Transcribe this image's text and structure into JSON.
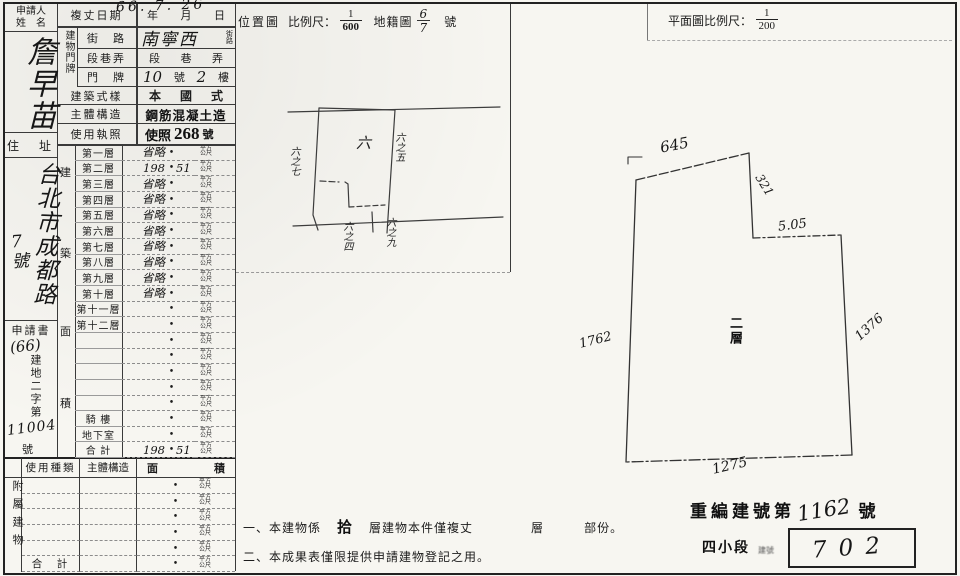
{
  "applicant": {
    "header_line1": "申請人",
    "header_line2": "姓　名",
    "name": "詹早苗",
    "address_label": "住　址",
    "address_main": "台北市成都路",
    "address_no": "7號",
    "form_label": "申請書",
    "form_year": "(66)",
    "form_word": "建地二字第",
    "form_no": "11004",
    "form_suffix": "號"
  },
  "survey": {
    "date_label": "複丈日期",
    "date_value": "66. 7. 26",
    "unit_y": "年",
    "unit_m": "月",
    "unit_d": "日"
  },
  "doorplate": {
    "group": "建物門牌",
    "street_label": "街　路",
    "street_value": "南寧西",
    "street_tiny_1": "街",
    "street_tiny_2": "路",
    "section_label": "段巷弄",
    "section_v1": "段",
    "section_v2": "巷",
    "section_v3": "弄",
    "door_label": "門　牌",
    "door_no": "10",
    "door_no_unit": "號",
    "door_floor": "2",
    "door_floor_unit": "樓"
  },
  "building": {
    "style_label": "建築式樣",
    "style_v1": "本",
    "style_v2": "國",
    "style_v3": "式",
    "structure_label": "主體構造",
    "structure_value": "鋼筋混凝土造",
    "license_label": "使用執照",
    "license_prefix": "使照",
    "license_no": "268",
    "license_suffix": "號"
  },
  "area_table": {
    "side_chars": {
      "c1": "建",
      "c2": "築",
      "c3": "面",
      "c4": "積"
    },
    "rows": [
      {
        "label": "第一層",
        "left": "省略",
        "right": ""
      },
      {
        "label": "第二層",
        "left": "198",
        "right": "51"
      },
      {
        "label": "第三層",
        "left": "省略",
        "right": ""
      },
      {
        "label": "第四層",
        "left": "省略",
        "right": ""
      },
      {
        "label": "第五層",
        "left": "省略",
        "right": ""
      },
      {
        "label": "第六層",
        "left": "省略",
        "right": ""
      },
      {
        "label": "第七層",
        "left": "省略",
        "right": ""
      },
      {
        "label": "第八層",
        "left": "省略",
        "right": ""
      },
      {
        "label": "第九層",
        "left": "省略",
        "right": ""
      },
      {
        "label": "第十層",
        "left": "省略",
        "right": ""
      },
      {
        "label": "第十一層",
        "left": "",
        "right": ""
      },
      {
        "label": "第十二層",
        "left": "",
        "right": ""
      },
      {
        "label": "",
        "left": "",
        "right": ""
      },
      {
        "label": "",
        "left": "",
        "right": ""
      },
      {
        "label": "",
        "left": "",
        "right": ""
      },
      {
        "label": "",
        "left": "",
        "right": ""
      },
      {
        "label": "",
        "left": "",
        "right": ""
      },
      {
        "label": "騎 樓",
        "left": "",
        "right": ""
      },
      {
        "label": "地下室",
        "left": "",
        "right": ""
      },
      {
        "label": "合 計",
        "left": "198",
        "right": "51"
      }
    ]
  },
  "units": {
    "dot": "•",
    "sqm1": "平方",
    "sqm2": "公尺"
  },
  "annex_table": {
    "side_label": "附屬建物",
    "h_use": "使用種類",
    "h_struct": "主體構造",
    "h_area_1": "面",
    "h_area_2": "積",
    "rows": [
      {
        "c1": "",
        "c2": "",
        "left": "",
        "right": ""
      },
      {
        "c1": "",
        "c2": "",
        "left": "",
        "right": ""
      },
      {
        "c1": "",
        "c2": "",
        "left": "",
        "right": ""
      },
      {
        "c1": "",
        "c2": "",
        "left": "",
        "right": ""
      },
      {
        "c1": "",
        "c2": "",
        "left": "",
        "right": ""
      },
      {
        "c1": "合　計",
        "c2": "",
        "left": "",
        "right": ""
      }
    ]
  },
  "location_map": {
    "title": "位置圖",
    "scale_label": "比例尺：",
    "scale_num": "1",
    "scale_den": "600",
    "cad_label": "地籍圖",
    "cad_num": "6",
    "cad_den": "7",
    "cad_suffix": "號",
    "lot_center": "六",
    "lot_left": "六之七",
    "lot_right": "六之五",
    "lot_bottom_left": "六之四",
    "lot_bottom_right": "六之九"
  },
  "floor_plan": {
    "title": "平面圖比例尺：",
    "scale_num": "1",
    "scale_den": "200",
    "dim_top": "645",
    "dim_upper_right": "321",
    "dim_step": "5.05",
    "dim_left": "1762",
    "dim_right": "1376",
    "dim_bottom": "1275",
    "room_label": "二層"
  },
  "notes": {
    "n1_a": "一、本建物係",
    "n1_b": "拾",
    "n1_c": "層建物本件僅複丈",
    "n1_d": "層",
    "n1_e": "部份。",
    "n2": "二、本成果表僅限提供申請建物登記之用。"
  },
  "stamp": {
    "renum_prefix": "重編建號第",
    "renum_no": "1162",
    "renum_suffix": "號",
    "section": "四小段",
    "section_small": "建號",
    "boxed_no": "702"
  }
}
